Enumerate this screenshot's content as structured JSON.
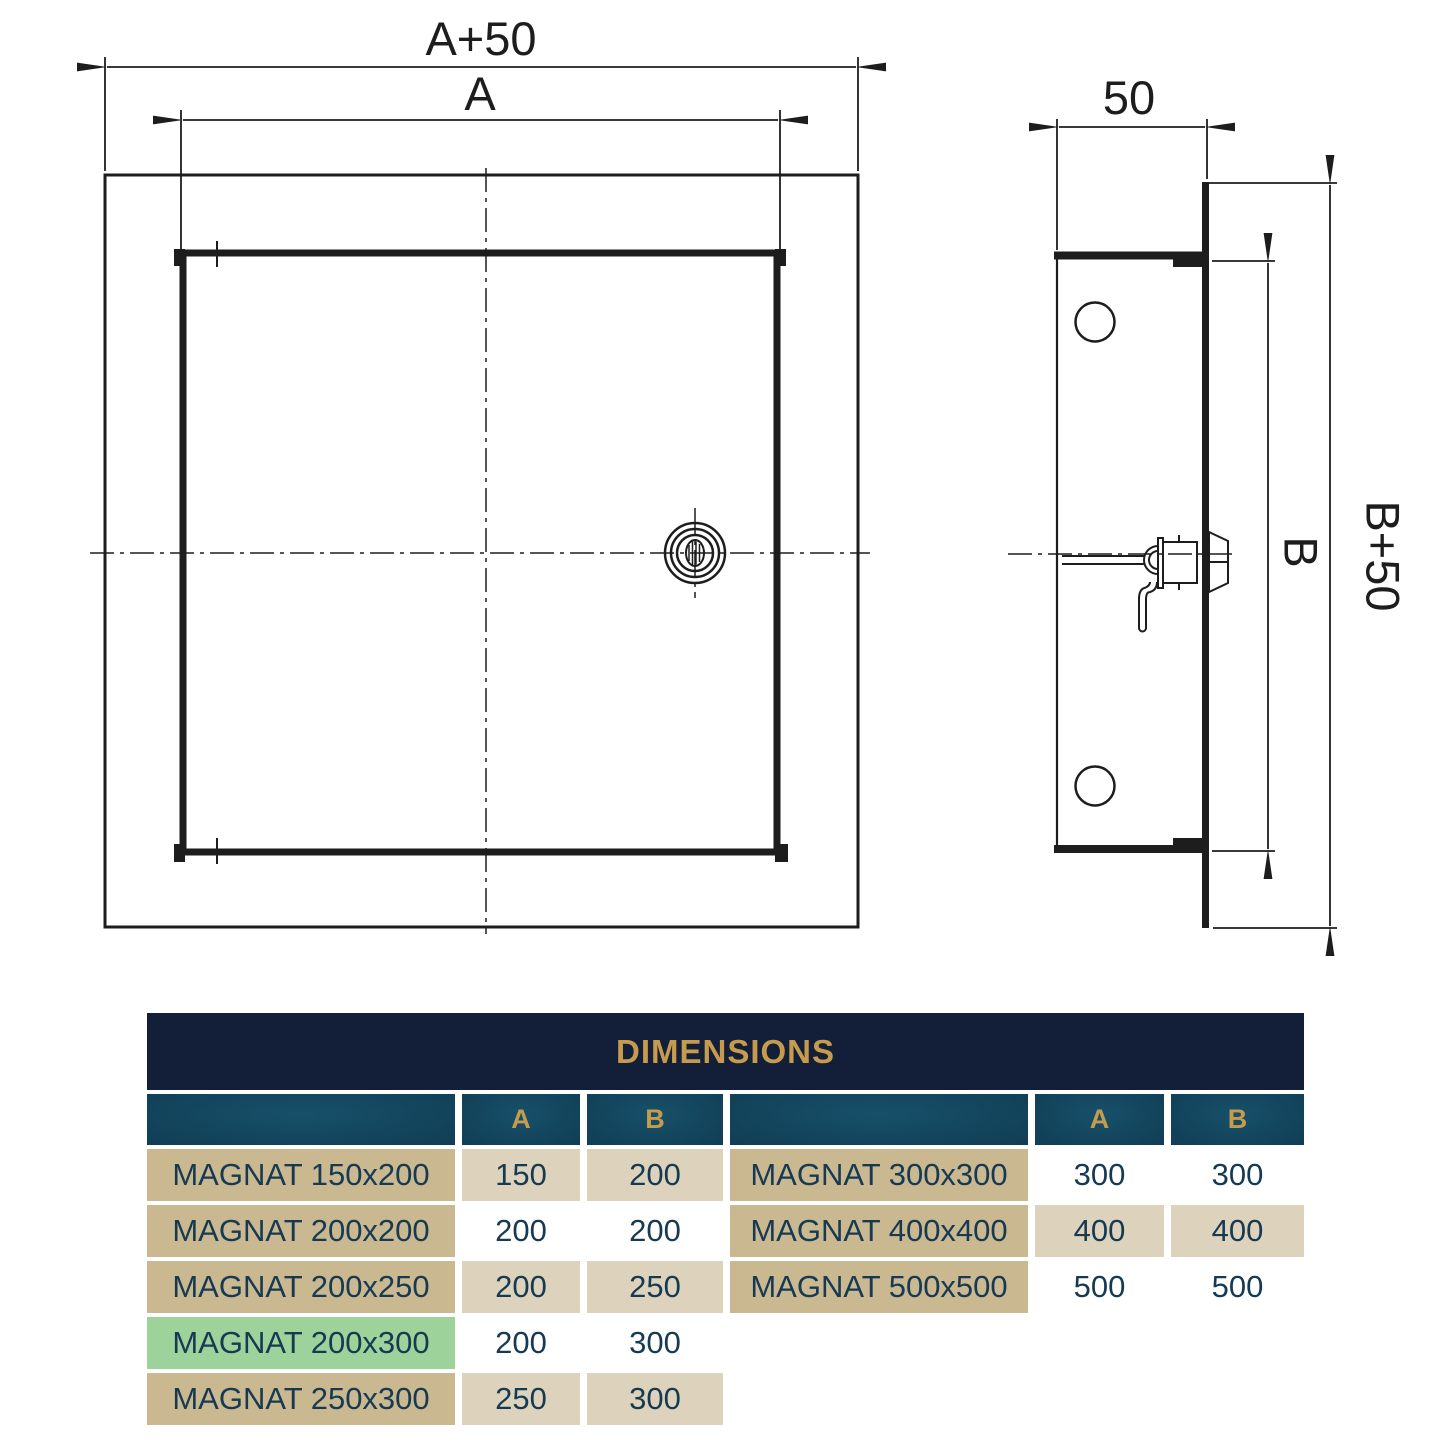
{
  "drawing": {
    "front_view": {
      "width_outer_label": "A+50",
      "width_inner_label": "A"
    },
    "side_view": {
      "depth_label": "50",
      "height_inner_label": "B",
      "height_outer_label": "B+50"
    }
  },
  "table": {
    "title": "DIMENSIONS",
    "col_a": "A",
    "col_b": "B",
    "left_rows": [
      {
        "name": "MAGNAT 150x200",
        "a": "150",
        "b": "200",
        "shade": "beige",
        "highlight": false
      },
      {
        "name": "MAGNAT 200x200",
        "a": "200",
        "b": "200",
        "shade": "white",
        "highlight": false
      },
      {
        "name": "MAGNAT 200x250",
        "a": "200",
        "b": "250",
        "shade": "beige",
        "highlight": false
      },
      {
        "name": "MAGNAT 200x300",
        "a": "200",
        "b": "300",
        "shade": "white",
        "highlight": true
      },
      {
        "name": "MAGNAT 250x300",
        "a": "250",
        "b": "300",
        "shade": "beige",
        "highlight": false
      }
    ],
    "right_rows": [
      {
        "name": "MAGNAT 300x300",
        "a": "300",
        "b": "300",
        "shade": "white"
      },
      {
        "name": "MAGNAT 400x400",
        "a": "400",
        "b": "400",
        "shade": "beige"
      },
      {
        "name": "MAGNAT 500x500",
        "a": "500",
        "b": "500",
        "shade": "white"
      }
    ],
    "colors": {
      "header_navy": "#131f38",
      "gold": "#c69b4e",
      "teal_dark": "#0c3349",
      "teal_light": "#175069",
      "tan": "#c9b890",
      "beige": "#ddd3bc",
      "green": "#9ed29b",
      "text_navy": "#173a52",
      "line_black": "#1d1d1d"
    }
  }
}
